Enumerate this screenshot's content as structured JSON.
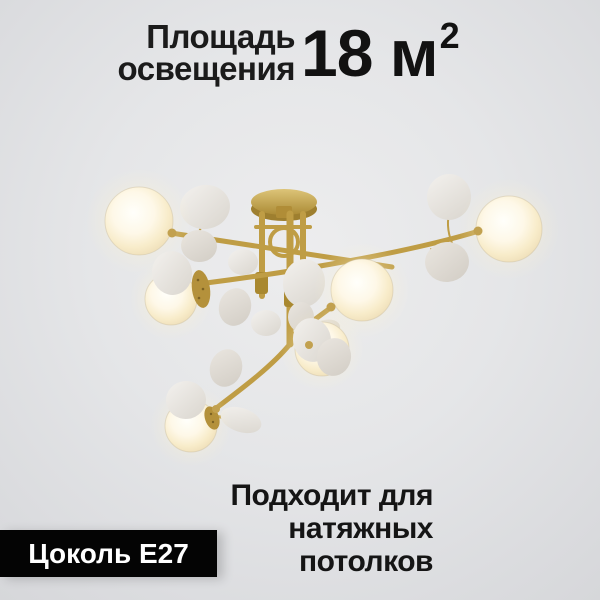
{
  "card": {
    "area": {
      "label_line1": "Площадь",
      "label_line2": "освещения",
      "value": "18 м",
      "superscript": "2"
    },
    "suitability": {
      "line1": "Подходит для",
      "line2": "натяжных",
      "line3": "потолков"
    },
    "socket_badge": {
      "label": "Цоколь E27"
    },
    "image": {
      "name": "brass-chandelier-with-white-petal-discs-and-glowing-glass-globes"
    },
    "colors": {
      "background_center": "#ededee",
      "background_edge": "#d6d7da",
      "text": "#161616",
      "badge_background": "#040404",
      "badge_text": "#ffffff",
      "gold": "#bf9d45",
      "petal": "#eceae5",
      "globe_glow": "#fff6dc"
    }
  }
}
